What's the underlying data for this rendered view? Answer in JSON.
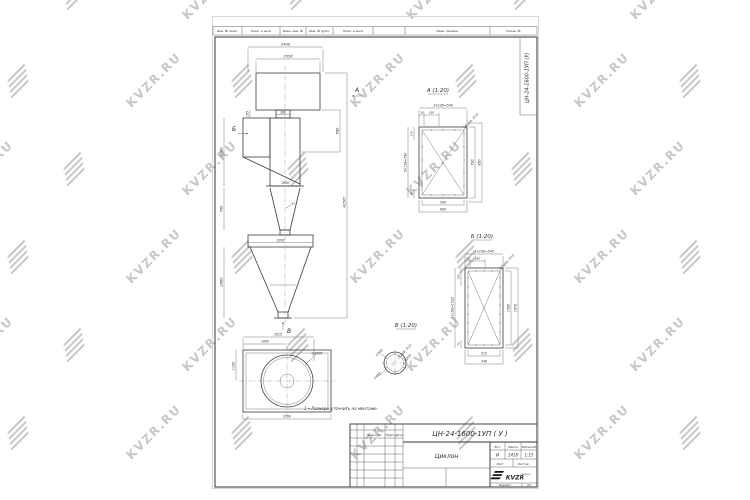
{
  "watermark": {
    "text": "KVZR.RU"
  },
  "strip": {
    "c1": "Инв. № подл.",
    "c2": "Подп. и дата",
    "c3": "Взам. инв. №",
    "c4": "Инв. № дубл.",
    "c5": "Подп. и дата",
    "c6": "Перв. примен.",
    "c7": "Справ. №"
  },
  "corner": {
    "designation": "ЦН-24-1600-1УП (У)"
  },
  "front": {
    "d2400": "2400",
    "d2056": "2056",
    "d380": "380",
    "d165": "165",
    "mark_b": "Б",
    "mark_a": "А",
    "d2160": "2160",
    "d580": "580",
    "d1630": "1630",
    "note1": "1*",
    "d700": "700",
    "d2200": "2200",
    "d2060": "2060",
    "d4150": "4150*",
    "mark_v": "В"
  },
  "plan": {
    "d1615": "1615",
    "d1065": "1065",
    "d1100": "1100",
    "d2200": "2200",
    "dia": "∅1600"
  },
  "secA": {
    "title": "А (1:20)",
    "top": "3×180=540",
    "s30": "30",
    "s180": "180",
    "note": "16 отв. ∅13",
    "left": "5×158=790",
    "l170": "170",
    "l30": "30",
    "r790": "790",
    "r850": "850",
    "b500": "500",
    "b600": "600"
  },
  "secB": {
    "title": "Б (1:20)",
    "top": "3×180=540",
    "s30": "30",
    "s180": "180",
    "note": "22 отв. ∅13",
    "left": "8×190=1520",
    "l190": "190",
    "l70": "70",
    "r1590": "1590",
    "r1670": "1670",
    "b512": "512",
    "b540": "540"
  },
  "viewV": {
    "title": "В (1:20)",
    "note": "6 отв. ∅12",
    "d395": "∅395",
    "d335": "∅335",
    "d450": "∅450"
  },
  "note": "1 • Размеры уточнить на монтаже.",
  "tb": {
    "designation": "ЦН-24-1600-1УП ( У )",
    "doc": "№ докум.",
    "sign": "Подп.",
    "date": "Дата",
    "name": "Циклон",
    "lit": "Лит.",
    "mass": "Масса",
    "scale": "Масштаб",
    "lit_v": "И",
    "mass_v": "1418",
    "scale_v": "1:15",
    "sheet": "Лист",
    "sheets": "Листов",
    "logo": "KVZR",
    "site": "kvzr.ru",
    "format": "Формат",
    "format_v": "А3"
  }
}
